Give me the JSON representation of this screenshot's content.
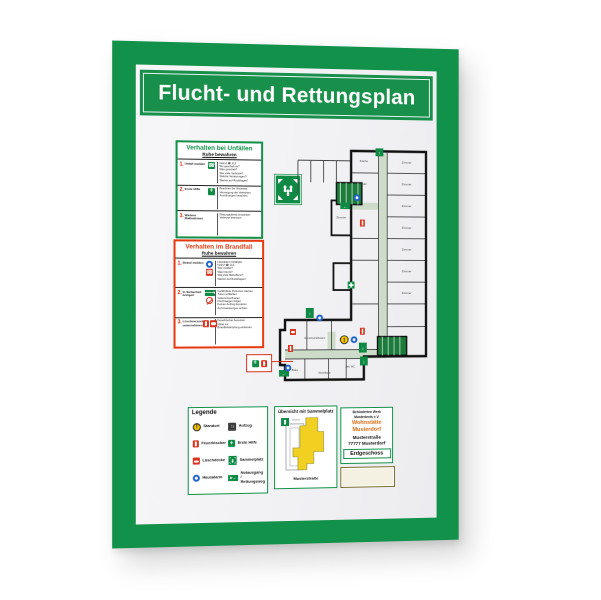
{
  "title": "Flucht- und Rettungsplan",
  "accident_box": {
    "title": "Verhalten bei Unfällen",
    "subtitle": "Ruhe bewahren",
    "rows": [
      {
        "num": "1.",
        "label": "Unfall melden",
        "text": "Notruf ☎ 112\nWo geschah es?\nWas geschah?\nWie viele Verletzte?\nWelche Verletzungen?\nWarten auf Rückfragen!"
      },
      {
        "num": "2.",
        "label": "Erste Hilfe",
        "text": "Beachten der Hinweise\nVersorgung der Verletzten\nAnordnungen beachten"
      },
      {
        "num": "3.",
        "label": "Weitere Maßnahmen",
        "text": "Rettungsdienst einweisen\nVerletzte betreuen"
      }
    ]
  },
  "fire_box": {
    "title": "Verhalten im Brandfall",
    "subtitle": "Ruhe bewahren",
    "rows": [
      {
        "num": "1.",
        "label": "Brand melden",
        "text": "Hausalarm betätigen\nNotruf ☎ 112\nWer meldet?\nWas brennt?\nWie viele Betroffene?\nWarten auf Rückfragen!"
      },
      {
        "num": "2.",
        "label": "In Sicherheit bringen",
        "text": "Gefährdete Personen warnen\nTüren schließen\nGekennzeichneten\nFluchtwegen folgen\nKeinen Aufzug benutzen\nAuf Anweisungen achten"
      },
      {
        "num": "3.",
        "label": "Löschversuch unternehmen",
        "text": "Feuerlöscher benutzen\nMittel zur\nBrandbekämpfung einsetzen"
      }
    ]
  },
  "plan": {
    "room_labels": [
      "Zimmer",
      "Zimmer",
      "Zimmer",
      "Zimmer",
      "Zimmer",
      "Zimmer",
      "Zimmer",
      "Zimmer",
      "Küche",
      "Bad",
      "Gemeinschaftsraum",
      "Büro",
      "Abstellraum",
      "Beh. WC"
    ]
  },
  "legend": {
    "title": "Legende",
    "items": [
      {
        "icon": "standort-icon",
        "label": "Standort"
      },
      {
        "icon": "aufzug-icon",
        "label": "Aufzug"
      },
      {
        "icon": "feuerloescher-icon",
        "label": "Feuerlöscher"
      },
      {
        "icon": "erste-hilfe-icon",
        "label": "Erste Hilfe"
      },
      {
        "icon": "loeschdecke-icon",
        "label": "Löschdecke"
      },
      {
        "icon": "sammelplatz-icon",
        "label": "Sammelplatz"
      },
      {
        "icon": "hausalarm-icon",
        "label": "Hausalarm"
      },
      {
        "icon": "notausgang-icon",
        "label": "Notausgang /\nRettungsweg"
      }
    ]
  },
  "overview": {
    "title": "Übersicht mit Sammelplatz",
    "street": "Musterstraße"
  },
  "address": {
    "org_line1": "Behinderten Werk",
    "org_line2": "Musterkreis e.V.",
    "name_line1": "Wohnstätte",
    "name_line2": "Musterdorf",
    "street": "Musterstraße",
    "city": "77777 Musterdorf",
    "floor": "Erdgeschoss"
  },
  "colors": {
    "frame_green": "#12914a",
    "banner_green": "#188f4a",
    "box_red": "#e63a10",
    "corridor_green": "#ccdcc9",
    "stair_green": "#1b7c3c",
    "exit_green": "#0e8a44",
    "alarm_blue": "#1f63c8",
    "extinguisher_red": "#d8311c",
    "standort_yellow": "#f5c400",
    "address_orange": "#e06a10"
  }
}
